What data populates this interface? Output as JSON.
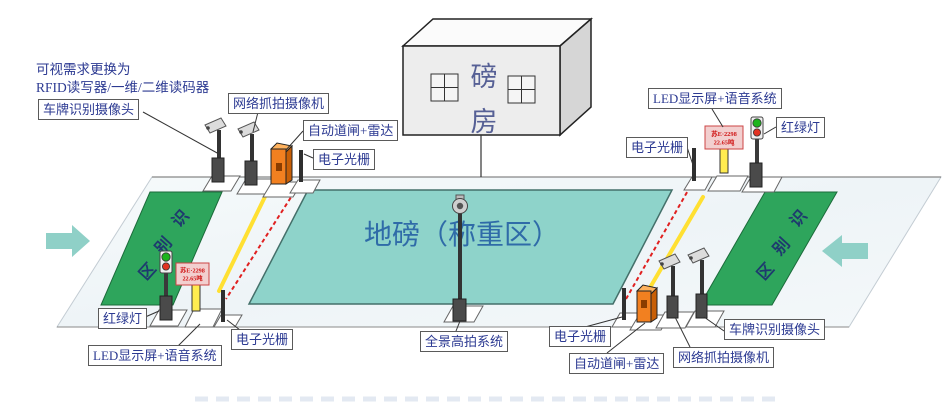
{
  "note": {
    "line1": "可视需求更换为",
    "line2": "RFID读写器/一维/二维读码器"
  },
  "building": {
    "char1": "磅",
    "char2": "房"
  },
  "weighbridge_label": "地磅（称重区）",
  "zone": {
    "chars": [
      "识",
      "别",
      "区"
    ]
  },
  "labels": {
    "plate_camera_top": "车牌识别摄像头",
    "net_camera_top": "网络抓拍摄像机",
    "barrier_radar_top": "自动道闸+雷达",
    "grating_top_left": "电子光栅",
    "grating_top_right": "电子光栅",
    "led_voice_top_right": "LED显示屏+语音系统",
    "traffic_light_top_right": "红绿灯",
    "traffic_light_bottom_left": "红绿灯",
    "led_voice_bottom_left": "LED显示屏+语音系统",
    "grating_bottom_left": "电子光栅",
    "panorama_system": "全景高拍系统",
    "grating_bottom_right": "电子光栅",
    "barrier_radar_bottom": "自动道闸+雷达",
    "net_camera_bottom": "网络抓拍摄像机",
    "plate_camera_bottom": "车牌识别摄像头"
  },
  "led_screen": {
    "line1": "苏E·2298",
    "line2": "22.65吨"
  },
  "colors": {
    "road": "#f1f6f8",
    "weighbridge_fill": "#8ed3ca",
    "zone_green": "#2ea55c",
    "arrow_teal": "#8fd0c7",
    "barrier_orange": "#f28020",
    "beam_red": "#e02020",
    "arm_yellow": "#ffe032",
    "label_blue": "#2c3a92",
    "weighbridge_text_blue": "#2f6ba8"
  }
}
